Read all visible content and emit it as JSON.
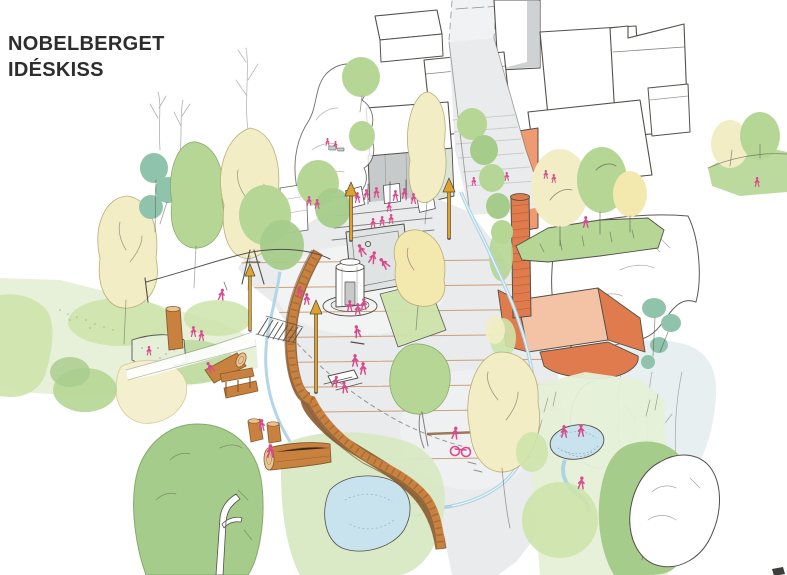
{
  "header": {
    "title_line1": "NOBELBERGET",
    "title_line2": "IDÉSKISS"
  },
  "palette": {
    "title": "#2d2d2d",
    "ink": "#53504a",
    "inkSoft": "#8b8a84",
    "figurePink": "#d9498c",
    "lampYellow": "#dfa32b",
    "woodOrange": "#c9813f",
    "woodDark": "#8a5a2e",
    "woodCut": "#e9c48f",
    "brick": "#df7b4d",
    "brickSoft": "#ef9a70",
    "brickLight": "#f4c2a4",
    "grayFacade": "#c7cacb",
    "sageFacade": "#dde3d6",
    "roadGray": "#e9ebec",
    "roadSunken": "#e0e3e4",
    "paveLine": "#c98a5d",
    "stepLine": "#c2c5c6",
    "treeYellow": "#f2edc4",
    "treeYellowDeep": "#f3e9af",
    "treeGreen": "#b5d694",
    "treeGreenLight": "#cde3aa",
    "treeGreenDark": "#a6cc8b",
    "treeTeal": "#8fc3ab",
    "grass": "#d8e9c4",
    "grassPale": "#e6f0d8",
    "pondBlue": "#c8e2ee",
    "streamBlue": "#aed4e4",
    "blueGrayWash": "#e3ecef",
    "sand": "#f4efcf",
    "mark": "#3f3e3c"
  }
}
